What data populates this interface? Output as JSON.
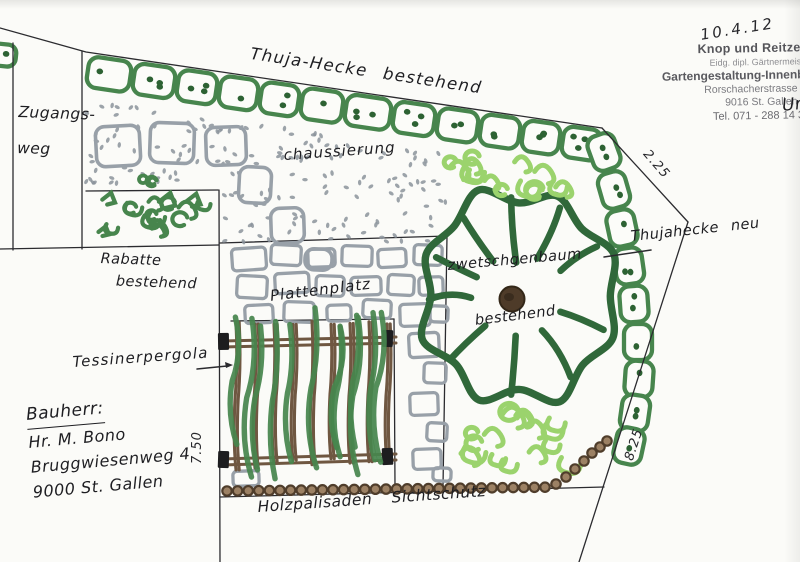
{
  "labels": {
    "thuja": "Thuja-Hecke bestehend",
    "zugangs1": "Zugangs-",
    "zugangs2": "weg",
    "chaussierung": "chaussierung",
    "rabatte1": "Rabatte",
    "rabatte2": "bestehend",
    "plattenplatz": "Plattenplatz",
    "baum1": "zwetschgenbaum",
    "baum2": "bestehend",
    "thujaneu": "Thujahecke neu",
    "pergola": "Tessinerpergola",
    "palisaden": "Holzpalisaden Sichtschutz"
  },
  "bauherr": {
    "title": "Bauherr:",
    "name": "Hr. M. Bono",
    "street": "Bruggwiesenweg 4",
    "city": "9000 St. Gallen"
  },
  "dims": {
    "d_top_right": "2.25",
    "d_right": "8.25",
    "d_pergola": "7.50"
  },
  "stamp": {
    "date": "10.4.12",
    "company": "Knop und Reitze AG",
    "sub": "Eidg. dipl. Gärtnermeister",
    "line3": "Gartengestaltung-Innenbegrünung",
    "street": "Rorschacherstrasse 308",
    "city": "9016 St. Gallen",
    "tel": "Tel. 071 - 288 14 37"
  },
  "note": "Un",
  "colors": {
    "ink": "#2b2b2f",
    "hedge": "#47854d",
    "hedgeDot": "#2d6233",
    "tree": "#30683a",
    "lightGreen": "#9bd36d",
    "stone": "#98a0a8",
    "gravel": "#8b939b",
    "brown": "#6f5741",
    "palisadeFill": "#9c8164",
    "palisadeEdge": "#4f3d2b",
    "trunk": "#4e3b29"
  }
}
